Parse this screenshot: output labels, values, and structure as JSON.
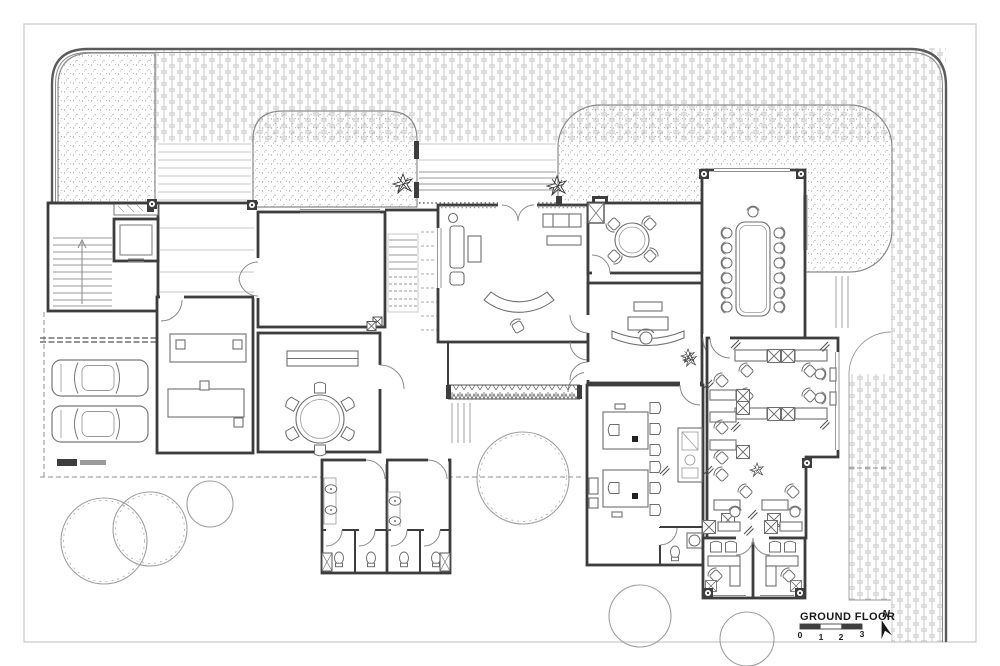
{
  "drawing": {
    "title": "GROUND FLOOR",
    "north_label": "N",
    "scale_bar": {
      "labels": [
        "0",
        "1",
        "2",
        "3"
      ]
    },
    "colors": {
      "paper": "#ffffff",
      "wall": "#3d3d3d",
      "furniture_line": "#6e6e6e",
      "paver_pattern": "#c2c2c2",
      "lawn_stipple": "#9b9b9b",
      "sheet_frame": "#cccccc",
      "dashed_line": "#8f8f8f"
    },
    "symbols": [
      "north-arrow-icon",
      "scale-bar",
      "tree-symbol",
      "plant-symbol",
      "car-symbol",
      "stair-symbol",
      "elevator-symbol",
      "wc-symbol",
      "washbasin-symbol",
      "column-marker",
      "workstation-chair",
      "door-swing"
    ]
  }
}
